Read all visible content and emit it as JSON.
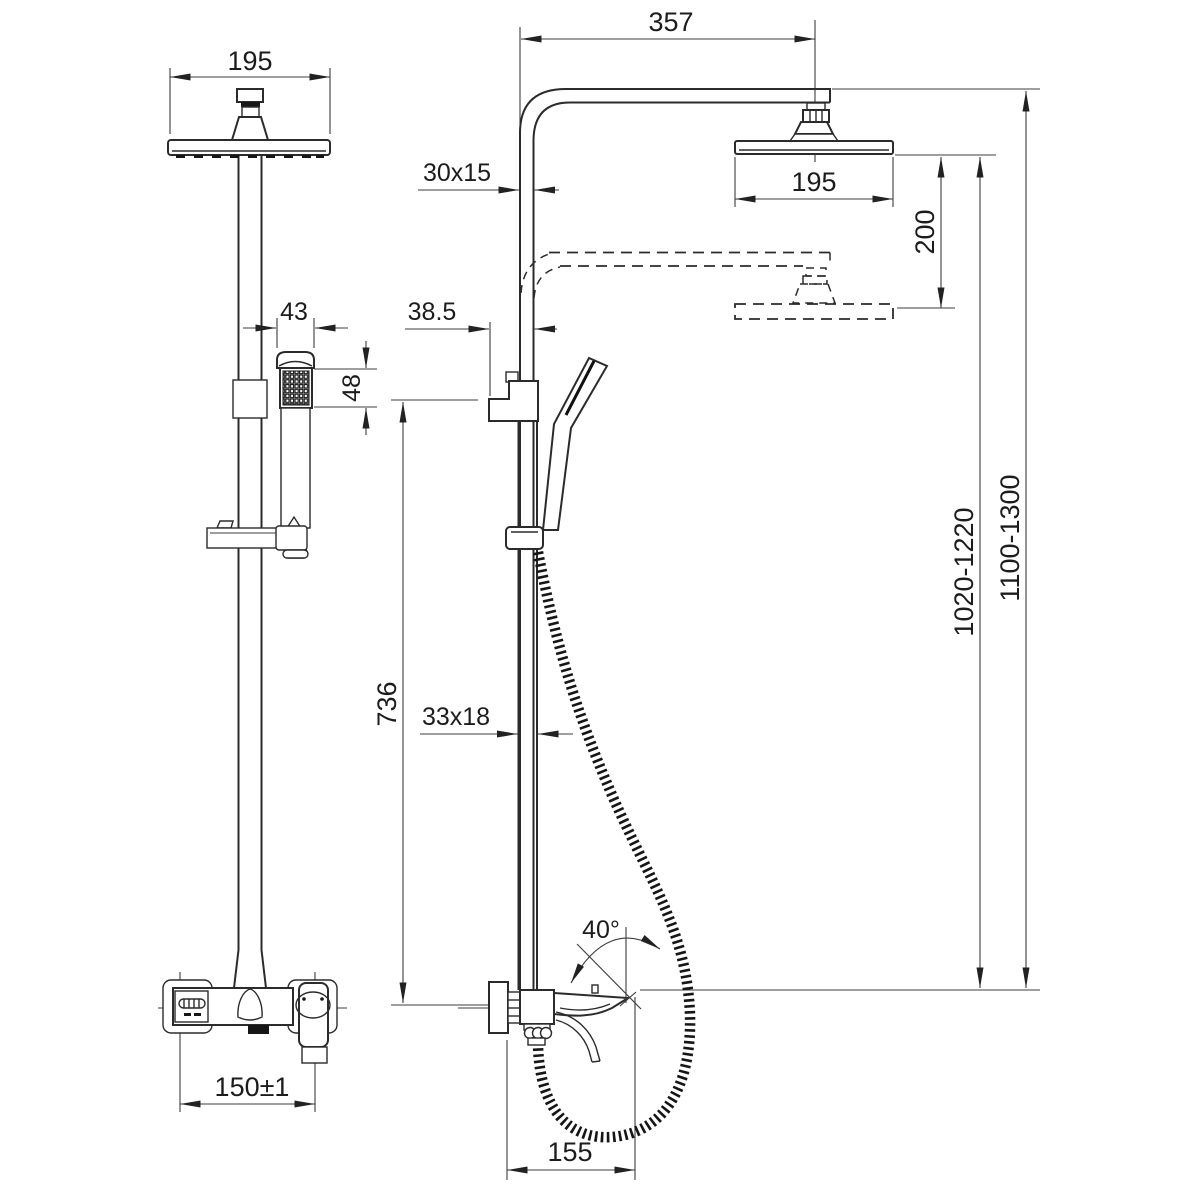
{
  "colors": {
    "line": "#2b2b2b",
    "dim_line": "#3c3c3c",
    "background": "#ffffff"
  },
  "dims": {
    "head_width_front": "195",
    "arm_reach": "357",
    "upper_pipe_profile": "30x15",
    "head_width_side": "195",
    "height_adjustment": "200",
    "handshower_width": "43",
    "handshower_face_height": "48",
    "holder_offset": "38.5",
    "column_height_range": "1020-1220",
    "overall_height_range": "1100-1300",
    "lower_column_length": "736",
    "lower_pipe_profile": "33x18",
    "handle_swing_angle": "40°",
    "inlet_centers": "150±1",
    "spout_projection": "155"
  }
}
